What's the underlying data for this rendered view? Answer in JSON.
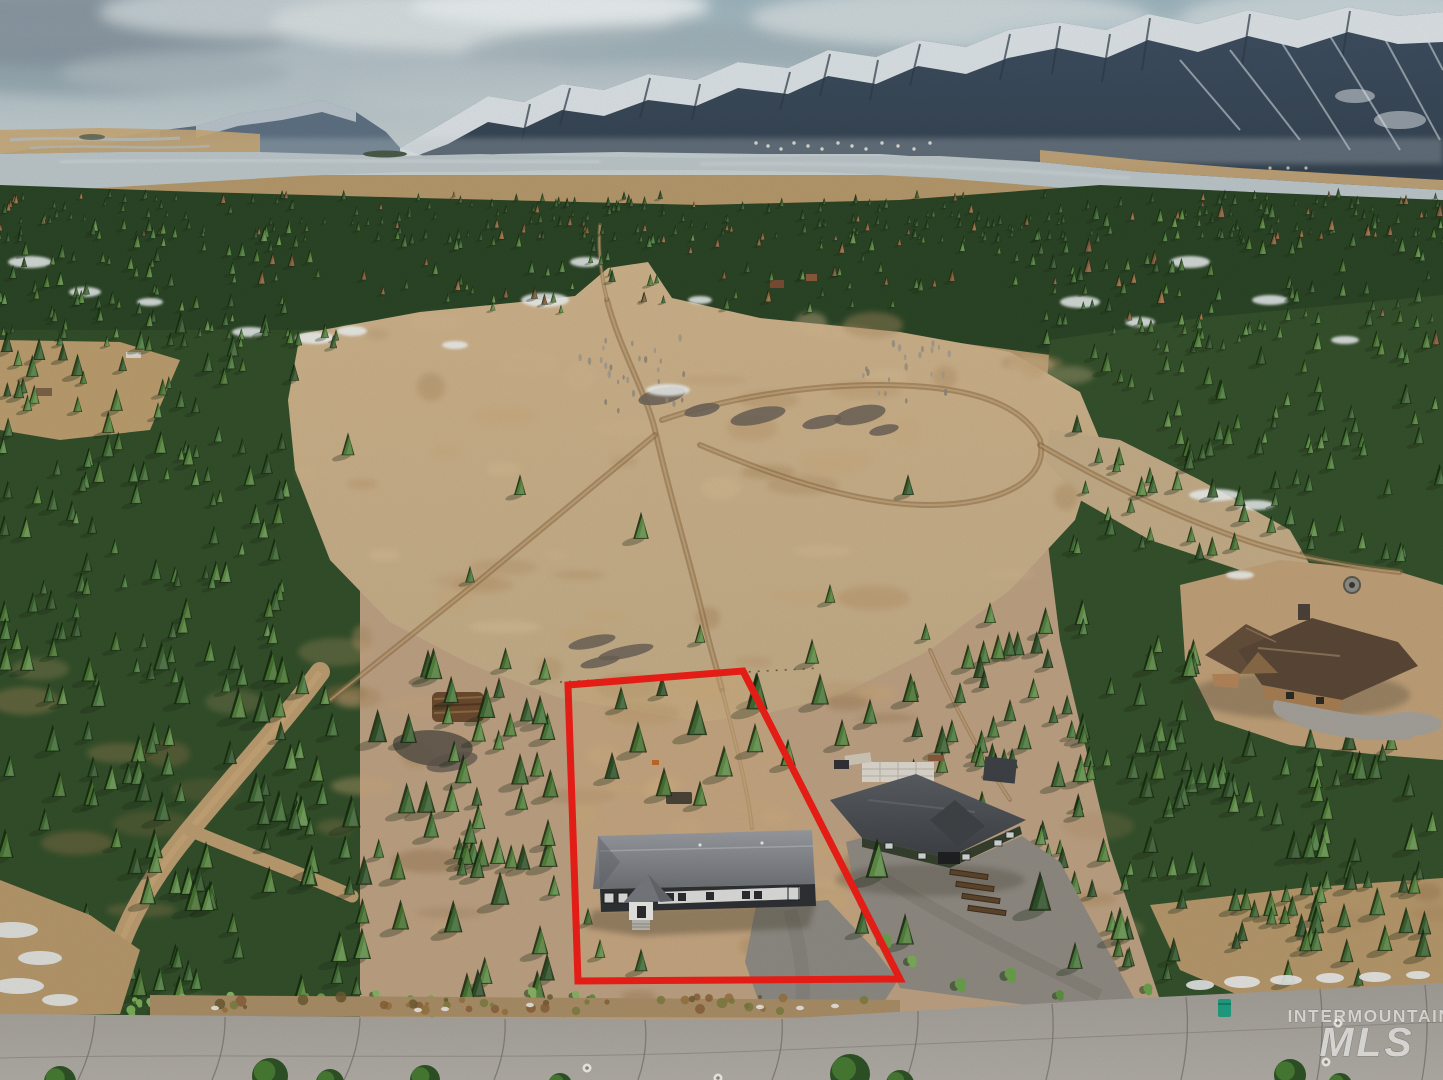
{
  "watermark": {
    "line1": "INTERMOUNTAIN",
    "line2": "MLS"
  },
  "scene": {
    "description": "Aerial drone photo of a treed residential lot outlined in red containing a long gray single-level home, a neighboring dark-green home with gravel drive, a log cabin, dirt double-track trails crossing a large tan meadow, dense pine forest, a lake and snow-capped mountains under a cloudy sky, with a paved road across the bottom.",
    "colors": {
      "outline_red": "#ee1f18",
      "sky_blue": "#a9c1c9",
      "meadow_tan": "#c3ac87",
      "forest_green": "#3a5f2e",
      "road_gray": "#a6a29b",
      "lake_gray": "#bcc6c9",
      "snow_white": "#eef2f3",
      "subject_roof_gray": "#7b7e82",
      "neighbor_roof_gray": "#474b4f",
      "cabin_roof_brown": "#5a4737"
    }
  }
}
